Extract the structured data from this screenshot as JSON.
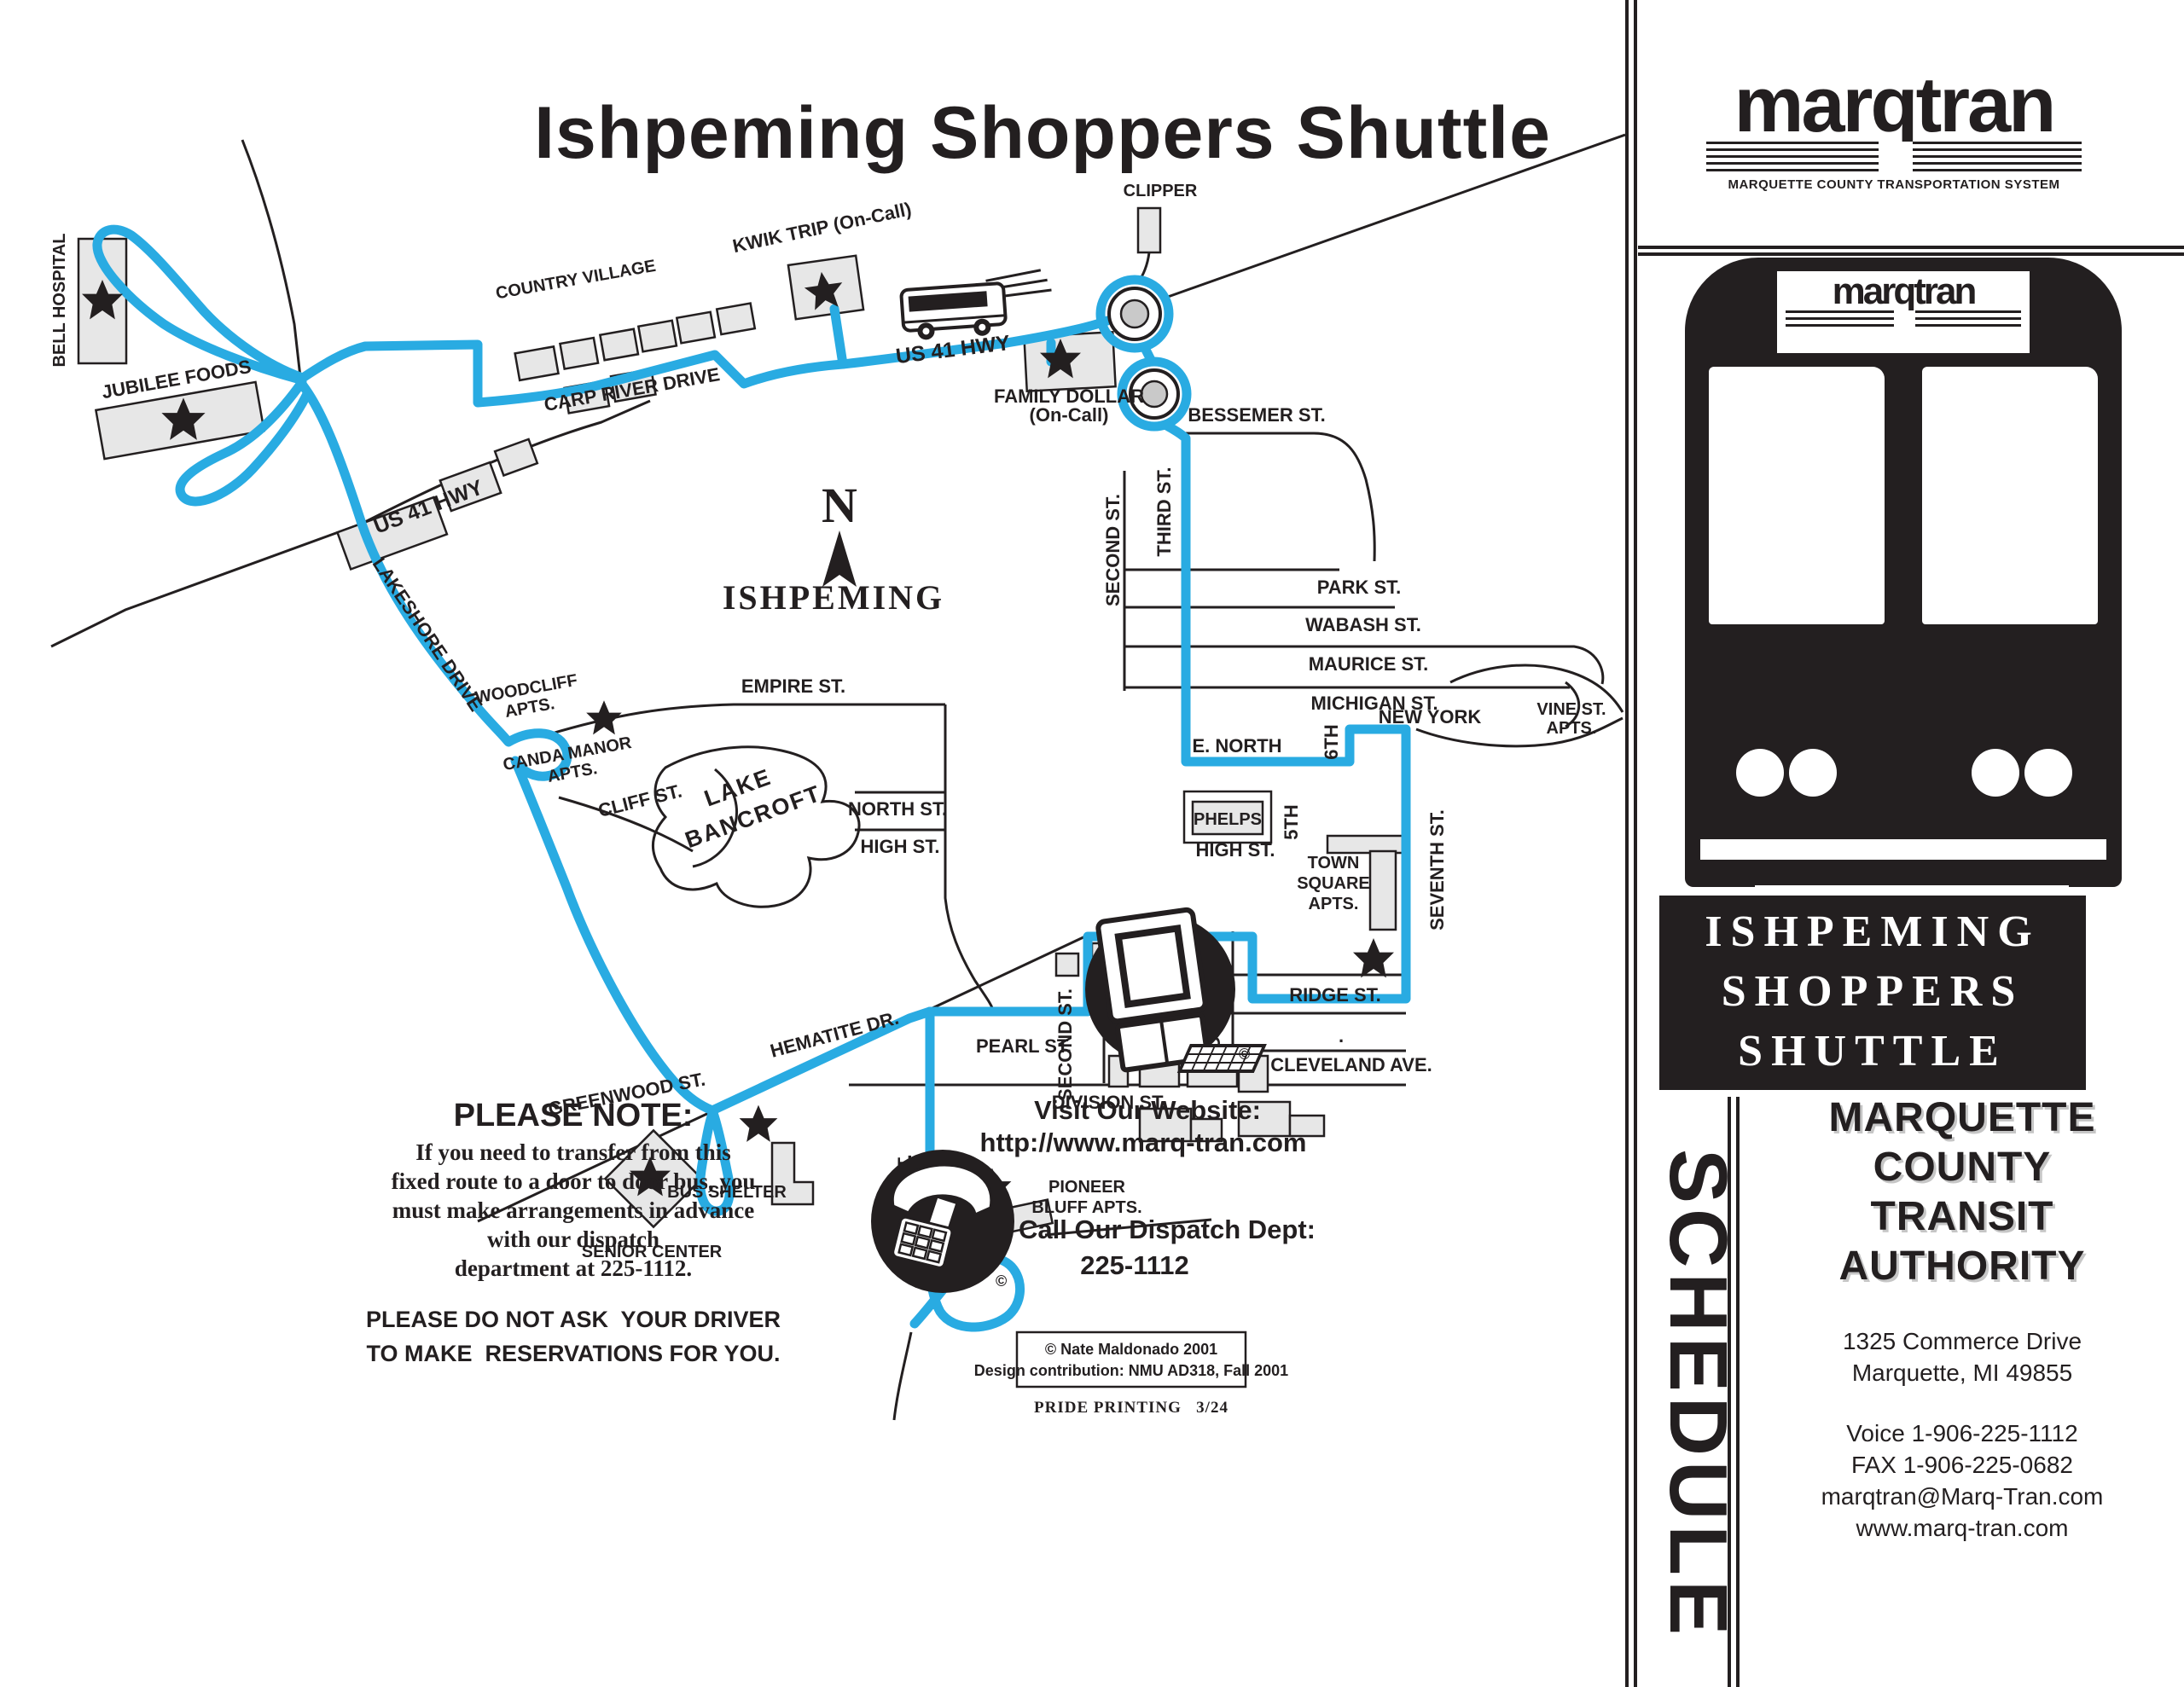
{
  "title": "Ishpeming Shoppers Shuttle",
  "colors": {
    "route": "#29ABE2",
    "ink": "#231F20",
    "building": "#E7E7E7"
  },
  "map": {
    "compass": "N",
    "city": "ISHPEMING",
    "lake1": "LAKE",
    "lake2": "BANCROFT",
    "streets": {
      "carp": "CARP RIVER DRIVE",
      "us41_east": "US 41 HWY",
      "us41_west": "US 41 HWY",
      "bessemer": "BESSEMER ST.",
      "second_n": "SECOND ST.",
      "third": "THIRD ST.",
      "park": "PARK ST.",
      "wabash": "WABASH ST.",
      "maurice": "MAURICE ST.",
      "michigan": "MICHIGAN ST.",
      "lakeshore": "LAKESHORE DRIVE",
      "cliff": "CLIFF ST.",
      "empire": "EMPIRE ST.",
      "north1": "NORTH ST.",
      "high1": "HIGH ST.",
      "enorth": "E. NORTH",
      "fifth": "5TH",
      "sixth": "6TH",
      "newyork": "NEW YORK",
      "high2": "HIGH ST.",
      "seventh": "SEVENTH ST.",
      "ridge": "RIDGE ST.",
      "fourth": "FOURTH ST.",
      "second_s": "SECOND ST.",
      "pearl": "PEARL ST.",
      "cleveland": "CLEVELAND AVE.",
      "division": "DIVISION ST.",
      "hematite": "HEMATITE DR.",
      "greenwood": "GREENWOOD ST.",
      "pine": "PINE ST.",
      "stray_dot": "."
    },
    "places": {
      "bell": "BELL HOSPITAL",
      "jubilee": "JUBILEE FOODS",
      "country": "COUNTRY VILLAGE",
      "kwik": "KWIK TRIP (On-Call)",
      "clipper": "CLIPPER",
      "family1": "FAMILY DOLLAR",
      "family2": "(On-Call)",
      "woodcliff1": "WOODCLIFF",
      "woodcliff2": "APTS.",
      "canda1": "CANDA MANOR",
      "canda2": "APTS.",
      "phelps": "PHELPS",
      "vine1": "VINE ST.",
      "vine2": "APTS.",
      "town1": "TOWN",
      "town2": "SQUARE",
      "town3": "APTS.",
      "jims1": "JIM'S",
      "jims2": "FOODS",
      "senior": "SENIOR CENTER",
      "shelter": "BUS SHELTER",
      "pioneer1": "PIONEER",
      "pioneer2": "BLUFF APTS."
    }
  },
  "note": {
    "heading": "PLEASE NOTE:",
    "line1": "If you need to transfer from this",
    "line2": "fixed route to a door to door bus, you",
    "line3": "must make arrangements in advance",
    "line4": "with our dispatch",
    "line5": "department at 225-1112.",
    "warn1": "PLEASE DO NOT ASK  YOUR DRIVER",
    "warn2": "TO MAKE  RESERVATIONS FOR YOU."
  },
  "contact": {
    "website_heading": "Visit Our Website:",
    "website_url": "http://www.marq-tran.com",
    "dispatch_heading": "Call Our Dispatch Dept:",
    "dispatch_phone": "225-1112",
    "copyright_mark": "©"
  },
  "credits": {
    "copyright": "© Nate Maldonado 2001",
    "design": "Design contribution: NMU AD318, Fall 2001",
    "printer": "PRIDE PRINTING   3/24"
  },
  "panel": {
    "logo": "marqtran",
    "tagline": "MARQUETTE COUNTY TRANSPORTATION SYSTEM",
    "bus_logo": "marqtran",
    "shuttle1": "ISHPEMING",
    "shuttle2": "SHOPPERS",
    "shuttle3": "SHUTTLE",
    "schedule": "SCHEDULE",
    "authority1": "MARQUETTE",
    "authority2": "COUNTY",
    "authority3": "TRANSIT",
    "authority4": "AUTHORITY",
    "address1": "1325 Commerce Drive",
    "address2": "Marquette, MI 49855",
    "voice": "Voice 1-906-225-1112",
    "fax": "FAX 1-906-225-0682",
    "email": "marqtran@Marq-Tran.com",
    "web": "www.marq-tran.com"
  }
}
